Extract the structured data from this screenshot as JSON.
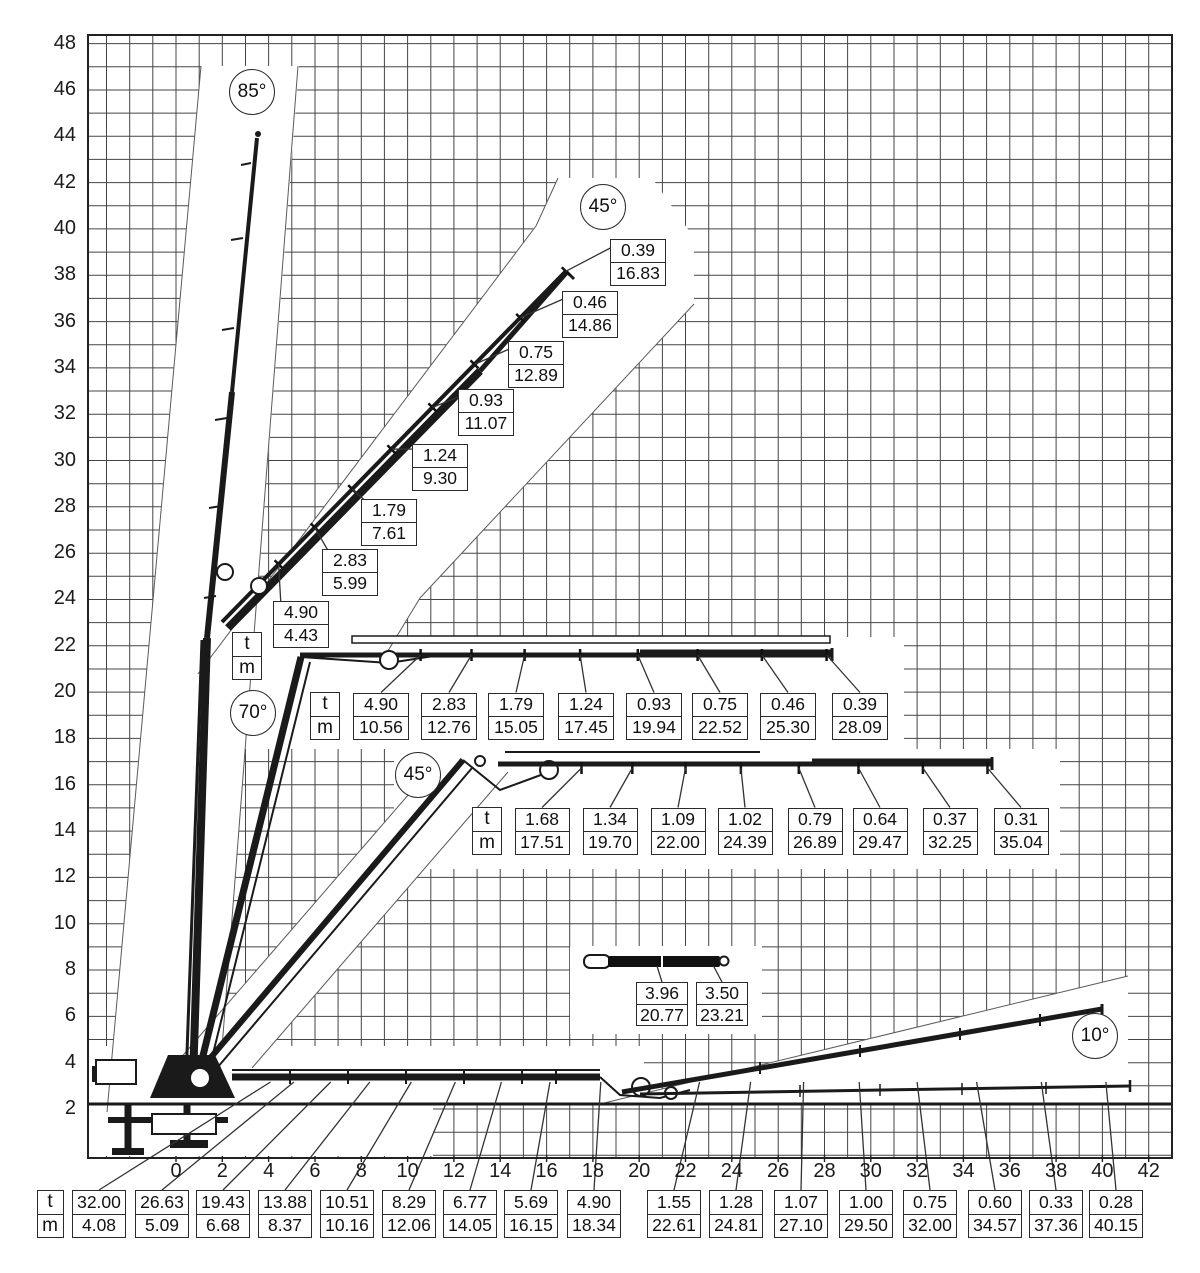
{
  "y_axis": {
    "ticks": [
      "48",
      "46",
      "44",
      "42",
      "40",
      "38",
      "36",
      "34",
      "32",
      "30",
      "28",
      "26",
      "24",
      "22",
      "20",
      "18",
      "16",
      "14",
      "12",
      "10",
      "8",
      "6",
      "4",
      "2"
    ]
  },
  "x_axis": {
    "ticks": [
      "0",
      "2",
      "4",
      "6",
      "8",
      "10",
      "12",
      "14",
      "16",
      "18",
      "20",
      "22",
      "24",
      "26",
      "28",
      "30",
      "32",
      "34",
      "36",
      "38",
      "40",
      "42"
    ]
  },
  "units": {
    "t": "t",
    "m": "m"
  },
  "badges": [
    {
      "label": "85°",
      "x": 252,
      "y": 92
    },
    {
      "label": "45°",
      "x": 603,
      "y": 207
    },
    {
      "label": "70°",
      "x": 253,
      "y": 713
    },
    {
      "label": "45°",
      "x": 418,
      "y": 775
    },
    {
      "label": "10°",
      "x": 1095,
      "y": 1036
    }
  ],
  "groups": [
    {
      "id": "boom-45-upper",
      "style": "diagonal",
      "unit_box": {
        "x": 247,
        "y": 656
      },
      "boxes": [
        {
          "t": "0.39",
          "m": "16.83",
          "x": 638,
          "y": 262
        },
        {
          "t": "0.46",
          "m": "14.86",
          "x": 590,
          "y": 314
        },
        {
          "t": "0.75",
          "m": "12.89",
          "x": 536,
          "y": 364
        },
        {
          "t": "0.93",
          "m": "11.07",
          "x": 486,
          "y": 412
        },
        {
          "t": "1.24",
          "m": "9.30",
          "x": 440,
          "y": 467
        },
        {
          "t": "1.79",
          "m": "7.61",
          "x": 389,
          "y": 522
        },
        {
          "t": "2.83",
          "m": "5.99",
          "x": 350,
          "y": 572
        },
        {
          "t": "4.90",
          "m": "4.43",
          "x": 301,
          "y": 624
        }
      ]
    },
    {
      "id": "boom-70-row",
      "style": "row",
      "target_y": 655,
      "unit_box": {
        "x": 325,
        "y": 716
      },
      "boxes": [
        {
          "t": "4.90",
          "m": "10.56",
          "x": 381,
          "y": 716
        },
        {
          "t": "2.83",
          "m": "12.76",
          "x": 449,
          "y": 716
        },
        {
          "t": "1.79",
          "m": "15.05",
          "x": 516,
          "y": 716
        },
        {
          "t": "1.24",
          "m": "17.45",
          "x": 586,
          "y": 716
        },
        {
          "t": "0.93",
          "m": "19.94",
          "x": 654,
          "y": 716
        },
        {
          "t": "0.75",
          "m": "22.52",
          "x": 720,
          "y": 716
        },
        {
          "t": "0.46",
          "m": "25.30",
          "x": 788,
          "y": 716
        },
        {
          "t": "0.39",
          "m": "28.09",
          "x": 860,
          "y": 716
        }
      ]
    },
    {
      "id": "boom-45-lower-row",
      "style": "row",
      "target_y": 768,
      "unit_box": {
        "x": 487,
        "y": 831
      },
      "boxes": [
        {
          "t": "1.68",
          "m": "17.51",
          "x": 542,
          "y": 831
        },
        {
          "t": "1.34",
          "m": "19.70",
          "x": 610,
          "y": 831
        },
        {
          "t": "1.09",
          "m": "22.00",
          "x": 678,
          "y": 831
        },
        {
          "t": "1.02",
          "m": "24.39",
          "x": 745,
          "y": 831
        },
        {
          "t": "0.79",
          "m": "26.89",
          "x": 815,
          "y": 831
        },
        {
          "t": "0.64",
          "m": "29.47",
          "x": 880,
          "y": 831
        },
        {
          "t": "0.37",
          "m": "32.25",
          "x": 950,
          "y": 831
        },
        {
          "t": "0.31",
          "m": "35.04",
          "x": 1021,
          "y": 831
        }
      ]
    },
    {
      "id": "jib-segment",
      "style": "row",
      "target_y": 966,
      "boxes": [
        {
          "t": "3.96",
          "m": "20.77",
          "x": 662,
          "y": 1004
        },
        {
          "t": "3.50",
          "m": "23.21",
          "x": 722,
          "y": 1004
        }
      ]
    },
    {
      "id": "ground-row",
      "style": "row",
      "target_y": 1082,
      "unit_box": {
        "x": 50,
        "y": 1214
      },
      "boxes": [
        {
          "t": "32.00",
          "m": "4.08",
          "x": 99,
          "y": 1214
        },
        {
          "t": "26.63",
          "m": "5.09",
          "x": 162,
          "y": 1214
        },
        {
          "t": "19.43",
          "m": "6.68",
          "x": 223,
          "y": 1214
        },
        {
          "t": "13.88",
          "m": "8.37",
          "x": 285,
          "y": 1214
        },
        {
          "t": "10.51",
          "m": "10.16",
          "x": 347,
          "y": 1214
        },
        {
          "t": "8.29",
          "m": "12.06",
          "x": 409,
          "y": 1214
        },
        {
          "t": "6.77",
          "m": "14.05",
          "x": 470,
          "y": 1214
        },
        {
          "t": "5.69",
          "m": "16.15",
          "x": 531,
          "y": 1214
        },
        {
          "t": "4.90",
          "m": "18.34",
          "x": 594,
          "y": 1214
        },
        {
          "t": "1.55",
          "m": "22.61",
          "x": 674,
          "y": 1214
        },
        {
          "t": "1.28",
          "m": "24.81",
          "x": 736,
          "y": 1214
        },
        {
          "t": "1.07",
          "m": "27.10",
          "x": 801,
          "y": 1214
        },
        {
          "t": "1.00",
          "m": "29.50",
          "x": 866,
          "y": 1214
        },
        {
          "t": "0.75",
          "m": "32.00",
          "x": 930,
          "y": 1214
        },
        {
          "t": "0.60",
          "m": "34.57",
          "x": 995,
          "y": 1214
        },
        {
          "t": "0.33",
          "m": "37.36",
          "x": 1056,
          "y": 1214
        },
        {
          "t": "0.28",
          "m": "40.15",
          "x": 1116,
          "y": 1214
        }
      ]
    }
  ]
}
